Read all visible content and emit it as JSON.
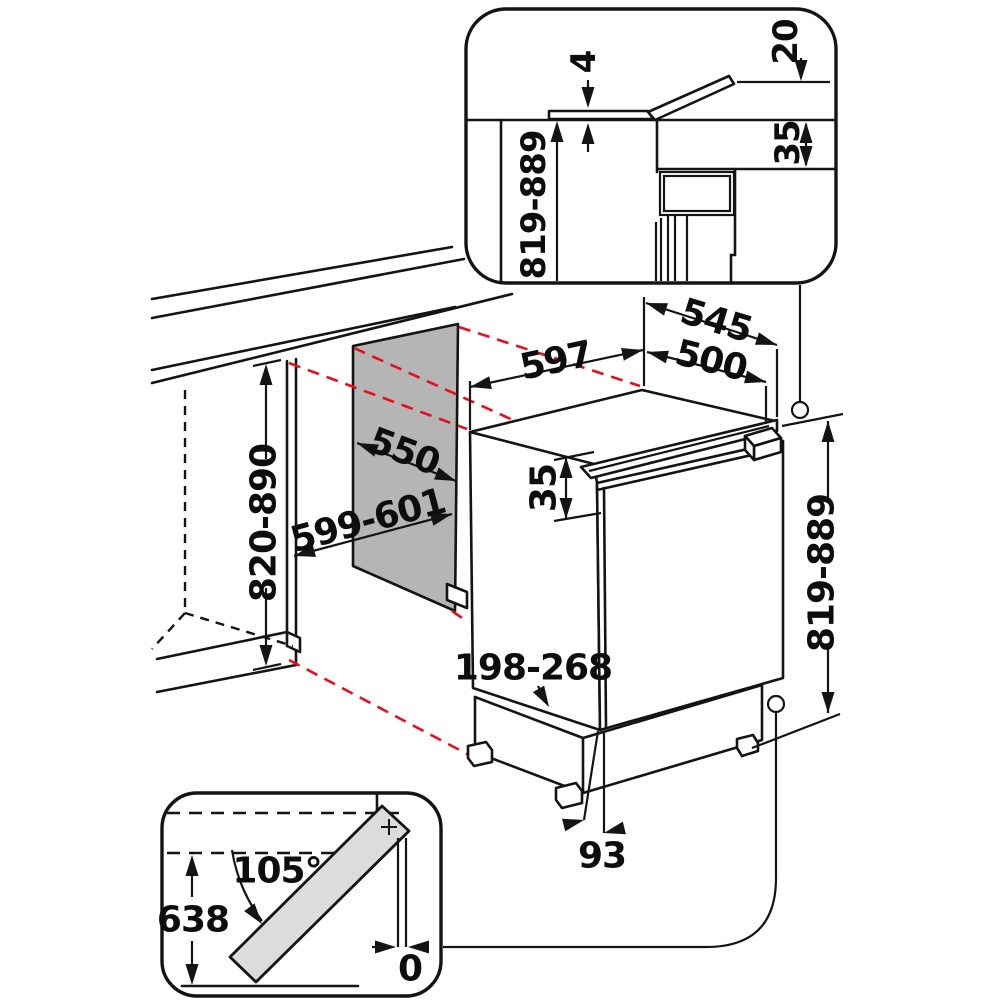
{
  "title": "Built-under refrigerator installation dimensions diagram",
  "colors": {
    "line": "#141414",
    "alignment_red": "#e60f1e",
    "niche_panel_gray": "#b5b5b5",
    "door_swing_gray": "#dcdcdc",
    "background": "#ffffff"
  },
  "insets": {
    "top_detail": {
      "dims": {
        "top_gap": "4",
        "flap_rise": "20",
        "hinge_offset": "35",
        "niche_height": "819-889"
      }
    },
    "door_swing": {
      "dims": {
        "opening_angle": "105°",
        "swing_height": "638",
        "side_clearance": "0"
      }
    }
  },
  "main_view": {
    "dims": {
      "appliance_width": "597",
      "appliance_depth_total": "545",
      "body_depth": "500",
      "niche_depth": "550",
      "niche_width": "599-601",
      "niche_height": "820-890",
      "door_top_offset": "35",
      "plinth_height": "198-268",
      "appliance_height": "819-889",
      "foot_setback": "93"
    }
  }
}
